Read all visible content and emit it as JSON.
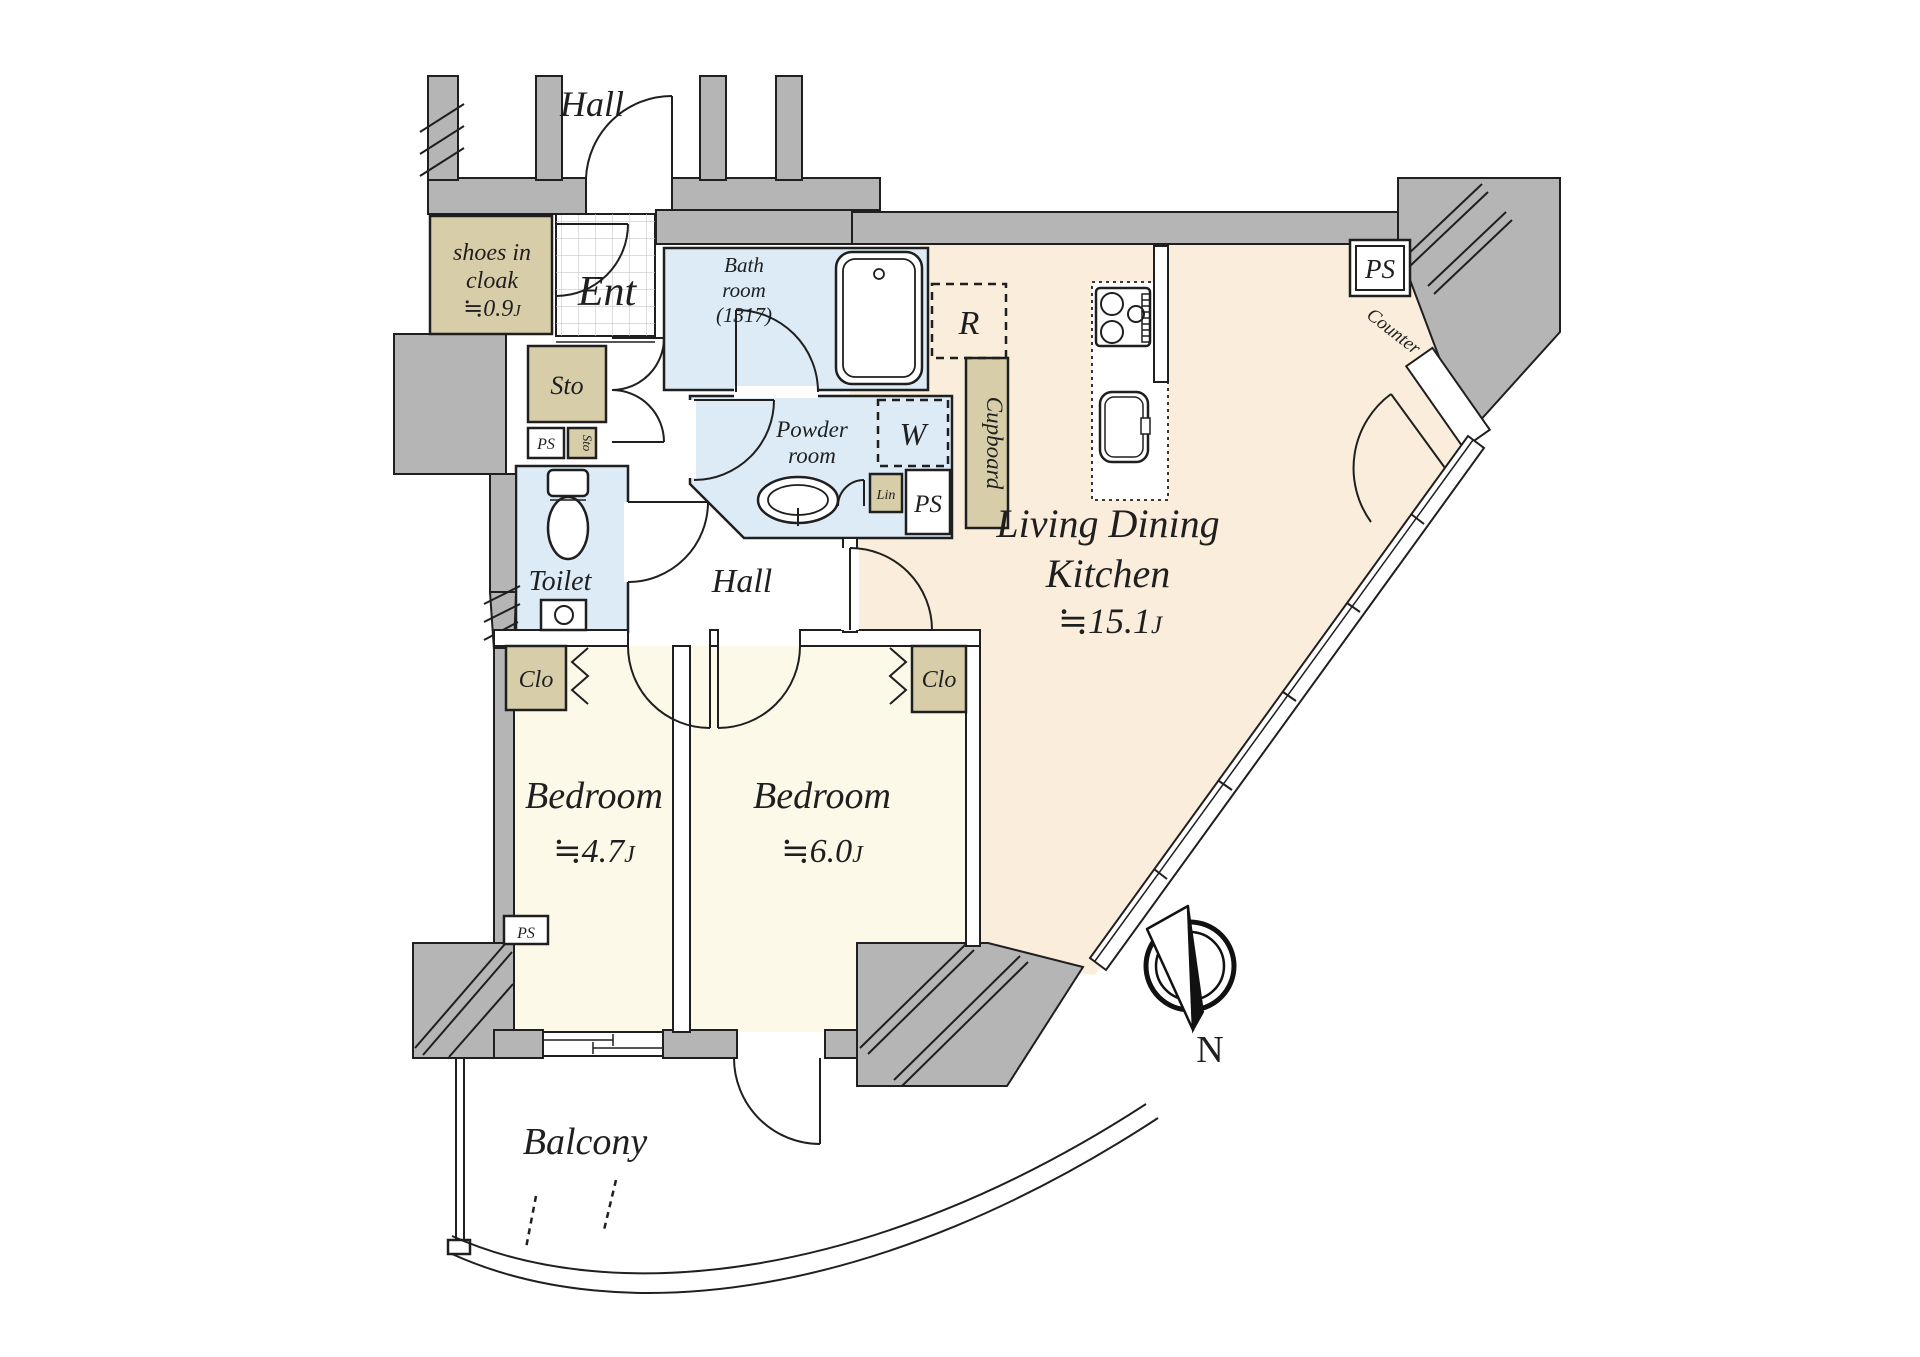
{
  "title": "Japanese apartment floor plan 2LDK",
  "colors": {
    "wall_gray": "#b5b5b5",
    "ldk_floor": "#faeddc",
    "bedroom_floor": "#fdf9e9",
    "wet_room_floor": "#dcebf6",
    "closet_tan": "#d8cda9",
    "line": "#1f1f1f"
  },
  "rooms": {
    "outside_hall": "Hall",
    "shoes_in_cloak": {
      "line1": "shoes in",
      "line2": "cloak",
      "area_approx": "≒0.9",
      "area_unit": "J"
    },
    "entrance": "Ent",
    "bathroom": {
      "line1": "Bath",
      "line2": "room",
      "line3": "(1317)"
    },
    "refrigerator_space": "R",
    "cupboard": "Cupboard",
    "powder_room": {
      "line1": "Powder",
      "line2": "room"
    },
    "washer_space": "W",
    "linen": "Lin",
    "storage": "Sto",
    "storage_small": "Sto",
    "pipe_space_entry": "PS",
    "pipe_space_powder": "PS",
    "pipe_space_kitchen": "PS",
    "pipe_space_bedroom": "PS",
    "toilet": "Toilet",
    "inner_hall": "Hall",
    "ldk": {
      "line1": "Living Dining",
      "line2": "Kitchen",
      "area_approx": "≒15.1",
      "area_unit": "J"
    },
    "counter": "Counter",
    "closet_bedroom1": "Clo",
    "closet_bedroom2": "Clo",
    "bedroom1": {
      "name": "Bedroom",
      "area_approx": "≒4.7",
      "area_unit": "J"
    },
    "bedroom2": {
      "name": "Bedroom",
      "area_approx": "≒6.0",
      "area_unit": "J"
    },
    "balcony": "Balcony",
    "compass_north": "N"
  }
}
